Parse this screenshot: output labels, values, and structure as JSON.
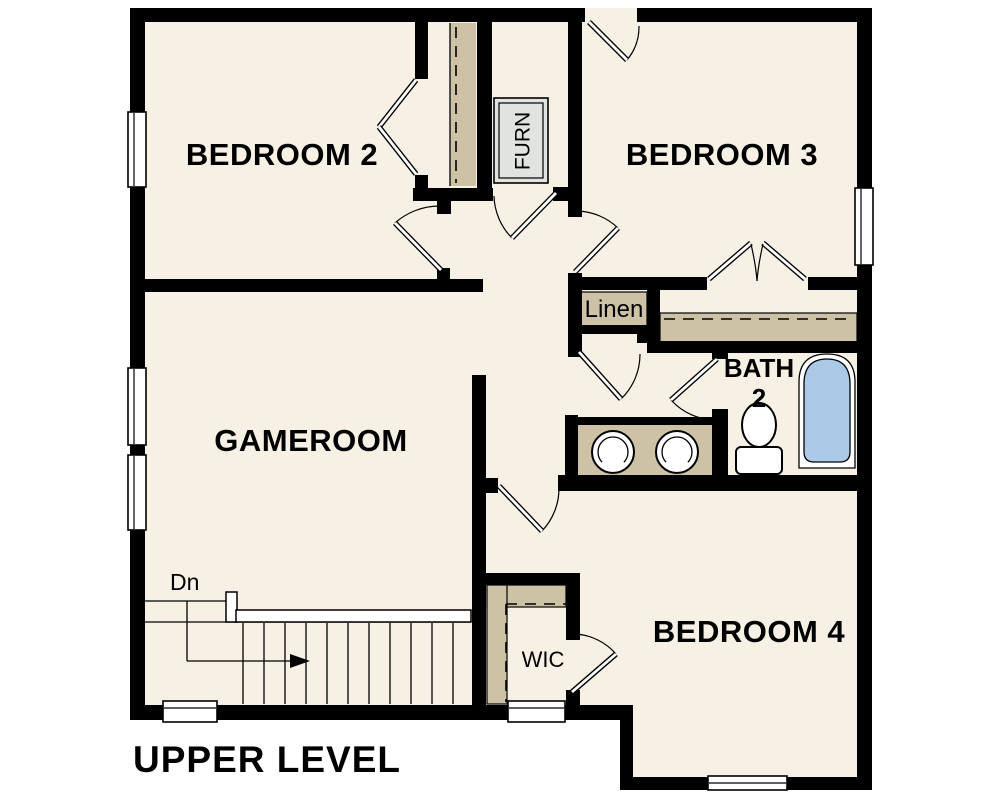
{
  "plan": {
    "title": "UPPER LEVEL",
    "rooms": {
      "bedroom2": "BEDROOM 2",
      "bedroom3": "BEDROOM 3",
      "gameroom": "GAMEROOM",
      "bedroom4": "BEDROOM 4",
      "bath2_line1": "BATH",
      "bath2_line2": "2",
      "linen": "Linen",
      "wic": "WIC",
      "furnace": "FURN"
    },
    "stairs": {
      "direction_label": "Dn"
    },
    "colors": {
      "floor": "#f7f0e4",
      "wall": "#000000",
      "closet_shelf": "#cdc2a6",
      "fixture_blue": "#a9c9e7",
      "furnace_gray": "#e0e3e0"
    }
  }
}
